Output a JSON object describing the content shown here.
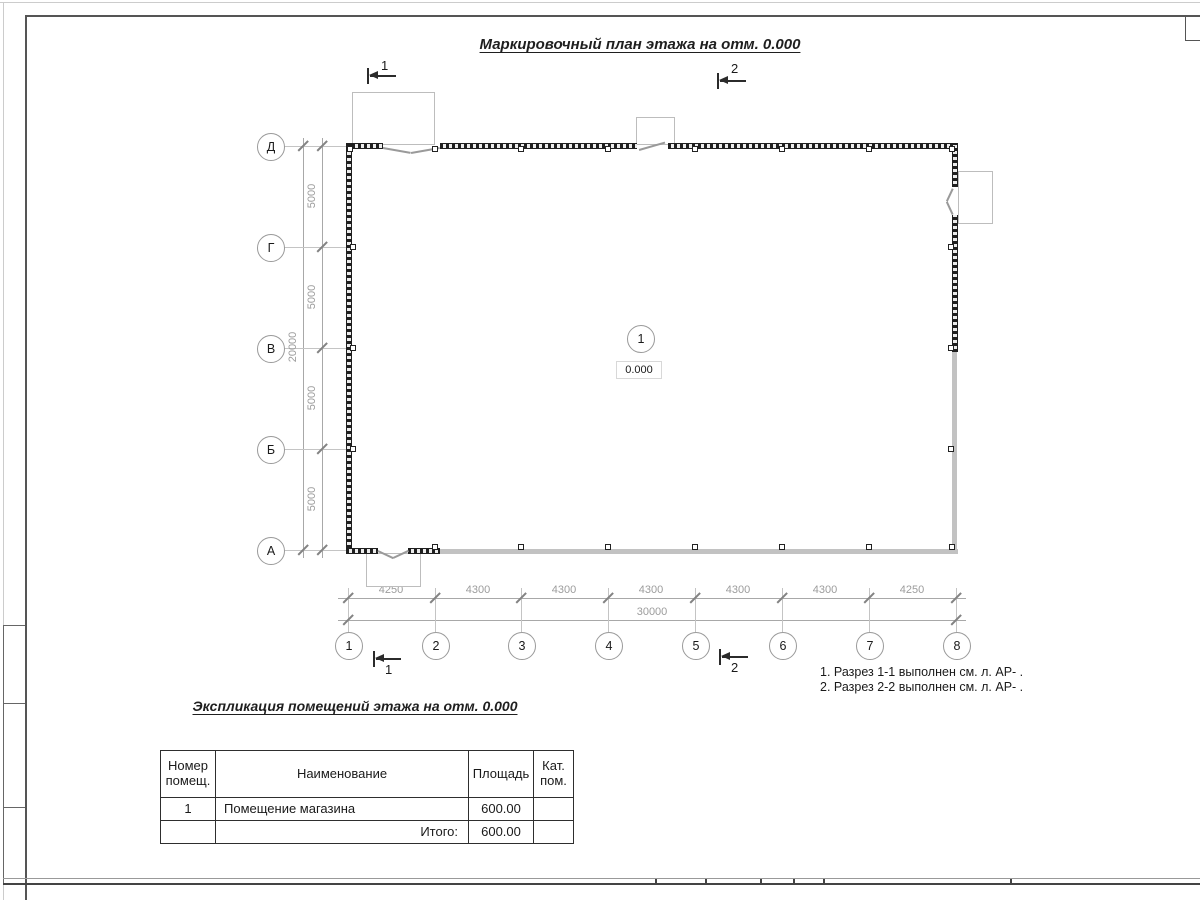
{
  "sheet": {
    "title": "Маркировочный план этажа на отм. 0.000"
  },
  "plan": {
    "row_axes": [
      "Д",
      "Г",
      "В",
      "Б",
      "А"
    ],
    "col_axes": [
      "1",
      "2",
      "3",
      "4",
      "5",
      "6",
      "7",
      "8"
    ],
    "row_dims": [
      "5000",
      "5000",
      "5000",
      "5000"
    ],
    "row_total": "20000",
    "col_dims": [
      "4250",
      "4300",
      "4300",
      "4300",
      "4300",
      "4300",
      "4250"
    ],
    "col_total": "30000",
    "room_tag": "1",
    "elevation": "0.000",
    "sections": {
      "one": "1",
      "two": "2"
    }
  },
  "notes": {
    "line1": "1. Разрез 1-1 выполнен см. л. АР- .",
    "line2": "2. Разрез 2-2 выполнен см. л. АР- ."
  },
  "explication": {
    "title": "Экспликация помещений этажа на отм. 0.000",
    "headers": [
      "Номер помещ.",
      "Наименование",
      "Площадь",
      "Кат. пом."
    ],
    "row": {
      "num": "1",
      "name": "Помещение магазина",
      "area": "600.00",
      "cat": ""
    },
    "total_label": "Итого:",
    "total_area": "600.00"
  },
  "colors": {
    "wall_dark": "#1f1f1f",
    "wall_glazed": "#c2c2c2",
    "dim_gray": "#9c9c9c",
    "frame_dark": "#555555"
  }
}
